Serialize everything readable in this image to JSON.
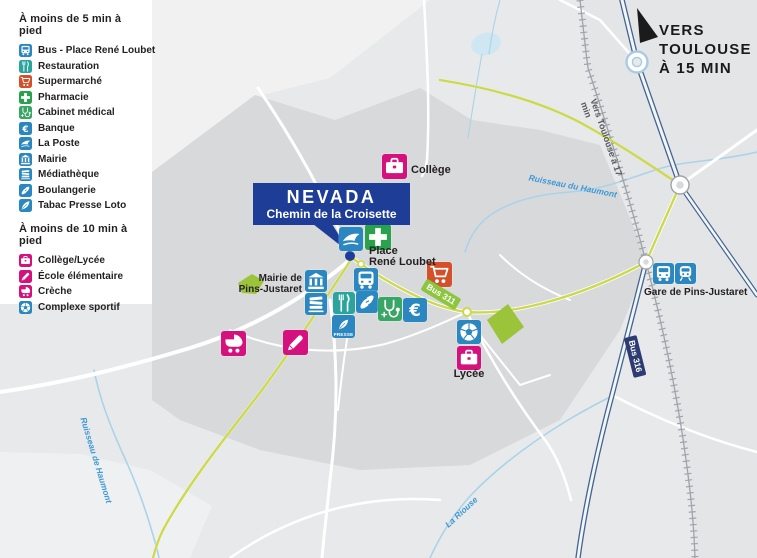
{
  "legend": {
    "section1": {
      "title": "À moins de 5 min à pied",
      "items": [
        {
          "icon": "bus-icon",
          "label": "Bus - Place René Loubet",
          "color": "#2a87bf"
        },
        {
          "icon": "restaurant-icon",
          "label": "Restauration",
          "color": "#2aa49d"
        },
        {
          "icon": "cart-icon",
          "label": "Supermarché",
          "color": "#d4502b"
        },
        {
          "icon": "cross-icon",
          "label": "Pharmacie",
          "color": "#2aa14c"
        },
        {
          "icon": "stethoscope-icon",
          "label": "Cabinet médical",
          "color": "#38a664"
        },
        {
          "icon": "euro-icon",
          "label": "Banque",
          "color": "#2a87bf"
        },
        {
          "icon": "laposte-bird-icon",
          "label": "La Poste",
          "color": "#2a87bf"
        },
        {
          "icon": "townhall-icon",
          "label": "Mairie",
          "color": "#2a87bf"
        },
        {
          "icon": "books-icon",
          "label": "Médiathèque",
          "color": "#2a87bf"
        },
        {
          "icon": "baguette-icon",
          "label": "Boulangerie",
          "color": "#2a87bf"
        },
        {
          "icon": "quill-icon",
          "label": "Tabac Presse Loto",
          "color": "#2a87bf"
        }
      ]
    },
    "section2": {
      "title": "À moins de 10 min à pied",
      "items": [
        {
          "icon": "briefcase-icon",
          "label": "Collège/Lycée",
          "color": "#d4117d"
        },
        {
          "icon": "pencil-icon",
          "label": "École élémentaire",
          "color": "#d4117d"
        },
        {
          "icon": "stroller-icon",
          "label": "Crèche",
          "color": "#d4117d"
        },
        {
          "icon": "soccer-ball-icon",
          "label": "Complexe sportif",
          "color": "#2a87bf"
        }
      ]
    }
  },
  "destination": {
    "line1": "VERS",
    "line2": "TOULOUSE",
    "line3": "À 15 MIN"
  },
  "project": {
    "name": "NEVADA",
    "address": "Chemin de la Croisette"
  },
  "map": {
    "labels": {
      "college": "Collège",
      "place_line1": "Place",
      "place_line2": "René Loubet",
      "mairie_line1": "Mairie de",
      "mairie_line2": "Pins-Justaret",
      "lycee": "Lycée",
      "gare": "Gare de Pins-Justaret",
      "bus311": "Bus 311",
      "bus316": "Bus 316",
      "rail": "Vers Toulouse à 17 min",
      "stream_haumont": "Ruisseau du Haumont",
      "stream_haumont2": "Ruisseau de Haumont",
      "stream_riouse": "La Riouse",
      "presse": "PRESSE"
    },
    "colors": {
      "project_navy": "#1e3d96",
      "legend_blue": "#2a87bf",
      "legend_pink": "#d4117d",
      "bus311_green": "#8cc63f",
      "bus316_navy": "#2c3b72",
      "route_line": "#ccd94c",
      "water": "#aad3ea",
      "urban_gray": "#d8d9db",
      "field_green": "#9bc43b"
    }
  }
}
